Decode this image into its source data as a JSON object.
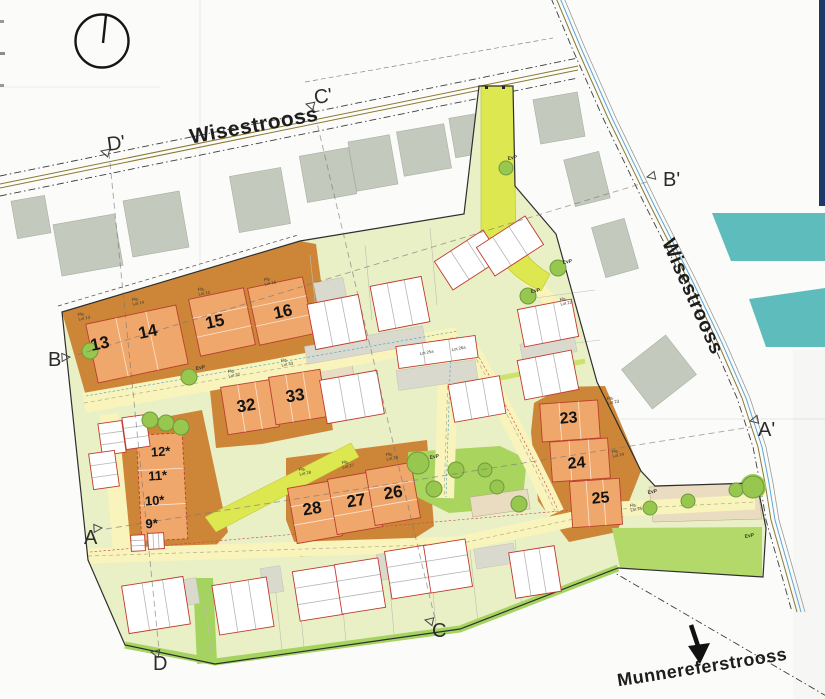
{
  "window": {
    "width": 825,
    "height": 699
  },
  "colors": {
    "brand_navy": "#1d3a66",
    "brand_teal": "#5fbcbd",
    "site_green": "#e9f0c6",
    "road_yellow": "#f8f4bc",
    "path_lime": "#dde74f",
    "park_green": "#a9d45e",
    "tree_green": "#97c74f",
    "plot_orange": "#cd8638",
    "building_orange": "#f0a76b",
    "building_red_outline": "#c0392f",
    "existing_gray": "#c3c9bd",
    "parking_beige": "#e9dcc0",
    "green_strip": "#a5d35f"
  },
  "streets": {
    "top": "Wisestrooss",
    "right": "Wisestrooss",
    "bottom": "Munnereferstrooss"
  },
  "compass": {
    "type": "north-indicator-circle"
  },
  "section_markers": [
    {
      "label": "D'",
      "x": 108,
      "y": 151,
      "rot": -8,
      "tx": 101,
      "ty": 151,
      "trot": 15
    },
    {
      "label": "C'",
      "x": 315,
      "y": 104,
      "rot": -8,
      "tx": 306,
      "ty": 104,
      "trot": 15
    },
    {
      "label": "B'",
      "x": 663,
      "y": 186,
      "rot": 0,
      "tx": 647,
      "ty": 177,
      "trot": -12
    },
    {
      "label": "A'",
      "x": 758,
      "y": 436,
      "rot": 0,
      "tx": 750,
      "ty": 421,
      "trot": -12
    },
    {
      "label": "B",
      "x": 48,
      "y": 366,
      "rot": 0,
      "tx": 70,
      "ty": 357,
      "trot": 177
    },
    {
      "label": "A",
      "x": 84,
      "y": 544,
      "rot": 0,
      "tx": 102,
      "ty": 528,
      "trot": 177
    },
    {
      "label": "C",
      "x": 432,
      "y": 637,
      "rot": 0,
      "tx": 425,
      "ty": 620,
      "trot": 12
    },
    {
      "label": "D",
      "x": 153,
      "y": 670,
      "rot": 0,
      "tx": 151,
      "ty": 652,
      "trot": 12
    }
  ],
  "plot_numbers": [
    {
      "label": "13",
      "x": 101,
      "y": 349,
      "s": 17,
      "rot": -12
    },
    {
      "label": "14",
      "x": 149,
      "y": 337,
      "s": 17,
      "rot": -12
    },
    {
      "label": "15",
      "x": 216,
      "y": 327,
      "s": 17,
      "rot": -12
    },
    {
      "label": "16",
      "x": 284,
      "y": 317,
      "s": 17,
      "rot": -12
    },
    {
      "label": "32",
      "x": 247,
      "y": 411,
      "s": 17,
      "rot": -9
    },
    {
      "label": "33",
      "x": 296,
      "y": 401,
      "s": 17,
      "rot": -9
    },
    {
      "label": "28",
      "x": 313,
      "y": 514,
      "s": 17,
      "rot": -9
    },
    {
      "label": "27",
      "x": 357,
      "y": 506,
      "s": 17,
      "rot": -9
    },
    {
      "label": "26",
      "x": 394,
      "y": 498,
      "s": 17,
      "rot": -9
    },
    {
      "label": "23",
      "x": 569,
      "y": 423,
      "s": 16,
      "rot": -5
    },
    {
      "label": "24",
      "x": 577,
      "y": 468,
      "s": 16,
      "rot": -5
    },
    {
      "label": "25",
      "x": 601,
      "y": 503,
      "s": 16,
      "rot": -5
    },
    {
      "label": "12*",
      "x": 161,
      "y": 456,
      "s": 13,
      "rot": -4
    },
    {
      "label": "11*",
      "x": 158,
      "y": 480,
      "s": 13,
      "rot": -4
    },
    {
      "label": "10*",
      "x": 155,
      "y": 505,
      "s": 13,
      "rot": -4
    },
    {
      "label": "9*",
      "x": 152,
      "y": 528,
      "s": 13,
      "rot": -4
    }
  ],
  "micro_labels": [
    {
      "t1": "EvP",
      "x": 430,
      "y": 459
    },
    {
      "t1": "EvP",
      "x": 531,
      "y": 293
    },
    {
      "t1": "EvP",
      "x": 563,
      "y": 264
    },
    {
      "t1": "EvP",
      "x": 648,
      "y": 494
    },
    {
      "t1": "EvP",
      "x": 196,
      "y": 370
    },
    {
      "t1": "EvP",
      "x": 508,
      "y": 160
    },
    {
      "t1": "EvP",
      "x": 745,
      "y": 538
    },
    {
      "t1": "Flg.",
      "t2": "Lot 13",
      "x": 78,
      "y": 316
    },
    {
      "t1": "Flg.",
      "t2": "Lot 14",
      "x": 132,
      "y": 301
    },
    {
      "t1": "Flg.",
      "t2": "Lot 15",
      "x": 198,
      "y": 291
    },
    {
      "t1": "Flg.",
      "t2": "Lot 16",
      "x": 264,
      "y": 281
    },
    {
      "t1": "Flg.",
      "t2": "Lot 22",
      "x": 560,
      "y": 301
    },
    {
      "t1": "Flg.",
      "t2": "Lot 23",
      "x": 607,
      "y": 400
    },
    {
      "t1": "Flg.",
      "t2": "Lot 24",
      "x": 612,
      "y": 453
    },
    {
      "t1": "Flg.",
      "t2": "Lot 25",
      "x": 630,
      "y": 507
    },
    {
      "t1": "Flg.",
      "t2": "Lot 26",
      "x": 386,
      "y": 456
    },
    {
      "t1": "Flg.",
      "t2": "Lot 27",
      "x": 342,
      "y": 464
    },
    {
      "t1": "Flg.",
      "t2": "Lot 28",
      "x": 299,
      "y": 471
    },
    {
      "t1": "Flg.",
      "t2": "Lot 32",
      "x": 228,
      "y": 373
    },
    {
      "t1": "Flg.",
      "t2": "Lot 33",
      "x": 281,
      "y": 362
    },
    {
      "t1": "Lot 25a",
      "x": 420,
      "y": 355
    },
    {
      "t1": "Lot 26a",
      "x": 452,
      "y": 351
    }
  ],
  "trees": [
    [
      150,
      420,
      8
    ],
    [
      166,
      423,
      8
    ],
    [
      181,
      427,
      8
    ],
    [
      189,
      377,
      8
    ],
    [
      90,
      351,
      8
    ],
    [
      506,
      168,
      7
    ],
    [
      528,
      296,
      8
    ],
    [
      558,
      268,
      8
    ],
    [
      418,
      463,
      11
    ],
    [
      434,
      489,
      8
    ],
    [
      456,
      470,
      8
    ],
    [
      485,
      470,
      7
    ],
    [
      497,
      487,
      7
    ],
    [
      519,
      504,
      8
    ],
    [
      650,
      508,
      7
    ],
    [
      688,
      501,
      7
    ],
    [
      736,
      490,
      7
    ],
    [
      753,
      487,
      11
    ]
  ],
  "existing_buildings": [
    [
      31,
      217,
      34,
      38,
      -10
    ],
    [
      88,
      245,
      62,
      52,
      -10
    ],
    [
      156,
      224,
      57,
      57,
      -10
    ],
    [
      260,
      200,
      52,
      57,
      -10
    ],
    [
      328,
      175,
      50,
      47,
      -10
    ],
    [
      373,
      163,
      42,
      50,
      -10
    ],
    [
      424,
      150,
      48,
      45,
      -10
    ],
    [
      470,
      135,
      36,
      40,
      -10
    ],
    [
      559,
      118,
      45,
      45,
      -10
    ],
    [
      587,
      179,
      36,
      48,
      -14
    ],
    [
      615,
      248,
      34,
      52,
      -16
    ],
    [
      659,
      372,
      56,
      50,
      -38
    ]
  ],
  "new_houses": [
    [
      337,
      322,
      52,
      46,
      -11
    ],
    [
      400,
      304,
      52,
      46,
      -11
    ],
    [
      468,
      260,
      58,
      34,
      -33
    ],
    [
      510,
      246,
      58,
      34,
      -33
    ],
    [
      548,
      323,
      55,
      38,
      -11
    ],
    [
      548,
      375,
      55,
      40,
      -11
    ],
    [
      352,
      397,
      58,
      44,
      -10
    ],
    [
      477,
      399,
      52,
      38,
      -10
    ],
    [
      437,
      352,
      80,
      22,
      -8
    ],
    [
      112,
      438,
      24,
      32,
      -8
    ],
    [
      136,
      432,
      24,
      32,
      -8
    ],
    [
      104,
      470,
      26,
      36,
      -8
    ],
    [
      156,
      605,
      62,
      48,
      -9
    ],
    [
      243,
      606,
      55,
      50,
      -9
    ],
    [
      318,
      593,
      44,
      50,
      -9
    ],
    [
      360,
      586,
      44,
      50,
      -9
    ],
    [
      409,
      572,
      42,
      48,
      -9
    ],
    [
      448,
      566,
      42,
      48,
      -9
    ],
    [
      535,
      572,
      46,
      46,
      -9
    ],
    [
      138,
      543,
      14,
      16,
      -3
    ],
    [
      156,
      541,
      16,
      16,
      -3
    ]
  ],
  "orange_houses": [
    [
      137,
      344,
      92,
      60,
      -12,
      0
    ],
    [
      222,
      322,
      56,
      58,
      -12,
      0
    ],
    [
      281,
      311,
      56,
      58,
      -12,
      0
    ],
    [
      250,
      407,
      52,
      48,
      -9,
      0
    ],
    [
      298,
      397,
      52,
      48,
      -9,
      0
    ],
    [
      315,
      512,
      46,
      56,
      -10,
      0
    ],
    [
      355,
      503,
      46,
      56,
      -10,
      0
    ],
    [
      393,
      494,
      46,
      56,
      -10,
      0
    ],
    [
      570,
      421,
      58,
      38,
      -4,
      0
    ],
    [
      580,
      460,
      58,
      40,
      -4,
      0
    ],
    [
      596,
      503,
      50,
      46,
      -4,
      0
    ],
    [
      162,
      487,
      46,
      106,
      -3,
      1
    ]
  ]
}
